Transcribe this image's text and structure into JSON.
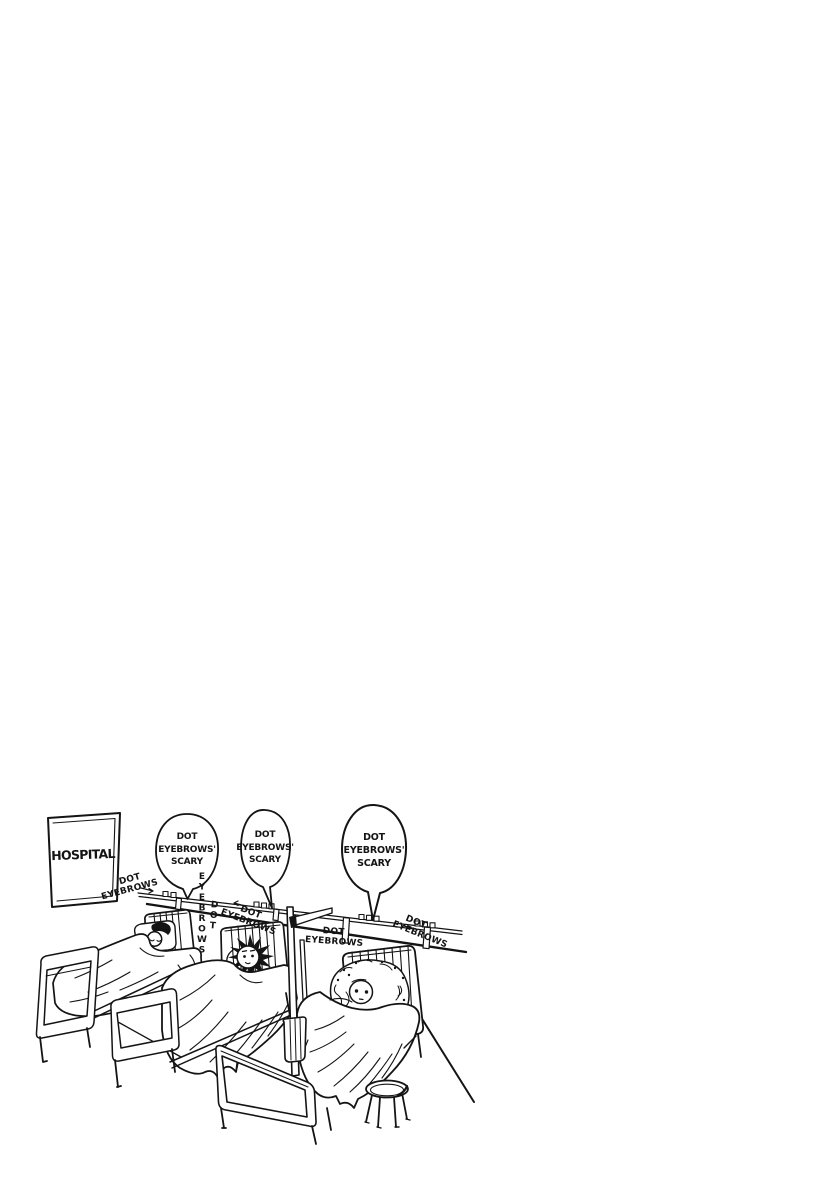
{
  "page": {
    "background": "#ffffff",
    "ink": "#141414"
  },
  "sign": {
    "text": "HOSPITAL"
  },
  "bubbles": [
    {
      "lines": [
        "DOT",
        "EYEBROWS'",
        "SCARY"
      ]
    },
    {
      "lines": [
        "DOT",
        "EYEBROWS'",
        "SCARY"
      ]
    },
    {
      "lines": [
        "DOT",
        "EYEBROWS'",
        "SCARY"
      ]
    }
  ],
  "labels": {
    "left": {
      "dot": "DOT",
      "eyebrows": "EYEBROWS"
    },
    "vertical": {
      "dot": "DOT",
      "eyebrows": "EYEBROWS"
    },
    "mid": {
      "dot": "DOT",
      "eyebrows": "EYEBROWS"
    },
    "center": {
      "dot": "DOT",
      "eyebrows": "EYEBROWS"
    },
    "right": {
      "dot": "DOT",
      "eyebrows": "EYEBROWS"
    }
  }
}
